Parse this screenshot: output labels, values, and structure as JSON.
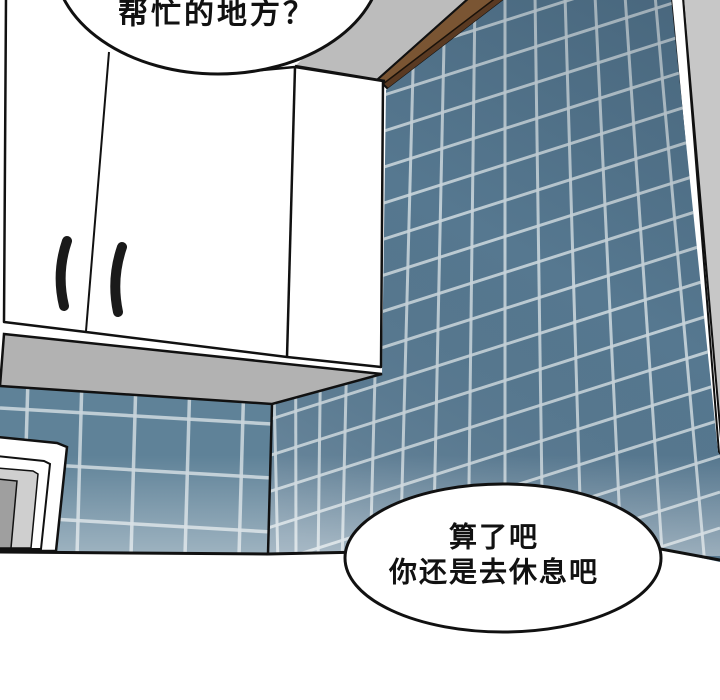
{
  "panel": {
    "type": "webtoon-comic-panel",
    "bubbles": {
      "top": {
        "text": "帮忙的地方？"
      },
      "bottom": {
        "lines": [
          "算了吧",
          "你还是去休息吧"
        ]
      }
    },
    "colors": {
      "outline": "#111111",
      "tile_right_wall": "#567890",
      "tile_left_wall": "#5f8298",
      "grout": "#c9d5dc",
      "ceiling_gray": "#bcbcbc",
      "cabinet_underside_gray": "#b2b2b2",
      "corner_wall_gray": "#c7c7c7",
      "trim_brown_light": "#7a5533",
      "trim_brown_dark": "#5a3a22",
      "window_frame_gray": "#cfcfcf",
      "window_pane_gray": "#9f9f9f",
      "cabinet_white": "#ffffff",
      "bubble_fill": "#ffffff",
      "text": "#111111"
    }
  }
}
